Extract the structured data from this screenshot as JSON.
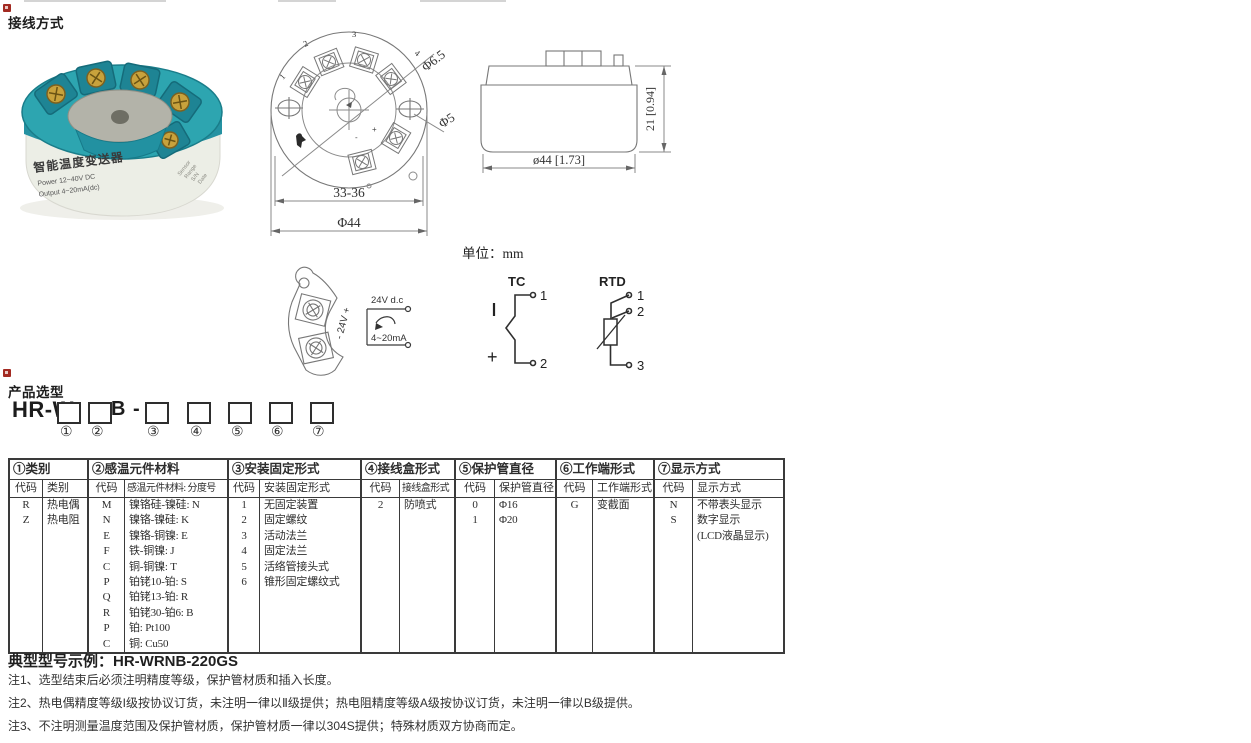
{
  "page": {
    "title_wiring": "接线方式",
    "title_selection": "产品选型",
    "unit_note": "单位：mm",
    "example_label": "典型型号示例：HR-WRNB-220GS",
    "notes": [
      "注1、选型结束后必须注明精度等级，保护管材质和插入长度。",
      "注2、热电偶精度等级I级按协议订货，未注明一律以Ⅱ级提供；热电阻精度等级A级按协议订货，未注明一律以B级提供。",
      "注3、不注明测量温度范围及保护管材质，保护管材质一律以304S提供；特殊材质双方协商而定。"
    ]
  },
  "photo": {
    "label_title": "智能温度变送器",
    "label_power": "Power  12~40V DC",
    "label_output": "Output  4~20mA(dc)",
    "side_lines": [
      "Sensor",
      "Range",
      "S/N",
      "Date"
    ],
    "colors": {
      "teal": "#2da5b0",
      "teal_dark": "#1e8494",
      "plate": "#b3b3a9",
      "screw": "#c8a23c",
      "label": "#efefe8"
    }
  },
  "top_view": {
    "hole_dim_large": "Φ6.5",
    "hole_dim_small": "Φ5",
    "span_dim": "33-36",
    "diameter_dim": "Φ44",
    "terminal_labels": [
      "1",
      "2",
      "3",
      "4"
    ],
    "polarity_plus": "+",
    "polarity_minus": "-"
  },
  "side_view": {
    "height_dim": "21 [0.94]",
    "width_dim": "ø44 [1.73]"
  },
  "power_loop": {
    "supply_label": "24V d.c",
    "current_label": "4~20mA",
    "terminal_polarity": "- 24V +"
  },
  "tc_diagram": {
    "title": "TC",
    "pin1": "1",
    "pin2": "2",
    "plus": "+"
  },
  "rtd_diagram": {
    "title": "RTD",
    "pin1": "1",
    "pin2": "2",
    "pin3": "3"
  },
  "model_code": {
    "prefix": "HR-W",
    "mid": "B -",
    "digits": [
      "①",
      "②",
      "③",
      "④",
      "⑤",
      "⑥",
      "⑦"
    ]
  },
  "selection_table": {
    "groups": [
      {
        "title": "①类别",
        "code_header": "代码",
        "desc_header": "类别",
        "rows": [
          [
            "R",
            "热电偶"
          ],
          [
            "Z",
            "热电阻"
          ]
        ]
      },
      {
        "title": "②感温元件材料",
        "code_header": "代码",
        "desc_header": "感温元件材料: 分度号",
        "rows": [
          [
            "M",
            "镍铬硅-镍硅: N"
          ],
          [
            "N",
            "镍铬-镍硅: K"
          ],
          [
            "E",
            "镍铬-铜镍: E"
          ],
          [
            "F",
            "铁-铜镍: J"
          ],
          [
            "C",
            "铜-铜镍: T"
          ],
          [
            "P",
            "铂铑10-铂: S"
          ],
          [
            "Q",
            "铂铑13-铂: R"
          ],
          [
            "R",
            "铂铑30-铂6: B"
          ],
          [
            "P",
            "铂: Pt100"
          ],
          [
            "C",
            "铜: Cu50"
          ]
        ]
      },
      {
        "title": "③安装固定形式",
        "code_header": "代码",
        "desc_header": "安装固定形式",
        "rows": [
          [
            "1",
            "无固定装置"
          ],
          [
            "2",
            "固定螺纹"
          ],
          [
            "3",
            "活动法兰"
          ],
          [
            "4",
            "固定法兰"
          ],
          [
            "5",
            "活络管接头式"
          ],
          [
            "6",
            "锥形固定螺纹式"
          ]
        ]
      },
      {
        "title": "④接线盒形式",
        "code_header": "代码",
        "desc_header": "接线盒形式",
        "rows": [
          [
            "2",
            "防喷式"
          ]
        ]
      },
      {
        "title": "⑤保护管直径",
        "code_header": "代码",
        "desc_header": "保护管直径",
        "rows": [
          [
            "0",
            "Φ16"
          ],
          [
            "1",
            "Φ20"
          ]
        ]
      },
      {
        "title": "⑥工作端形式",
        "code_header": "代码",
        "desc_header": "工作端形式",
        "rows": [
          [
            "G",
            "变截面"
          ]
        ]
      },
      {
        "title": "⑦显示方式",
        "code_header": "代码",
        "desc_header": "显示方式",
        "rows": [
          [
            "N",
            "不带表头显示"
          ],
          [
            "S",
            "数字显示"
          ],
          [
            "",
            "(LCD液晶显示)"
          ]
        ]
      }
    ]
  }
}
